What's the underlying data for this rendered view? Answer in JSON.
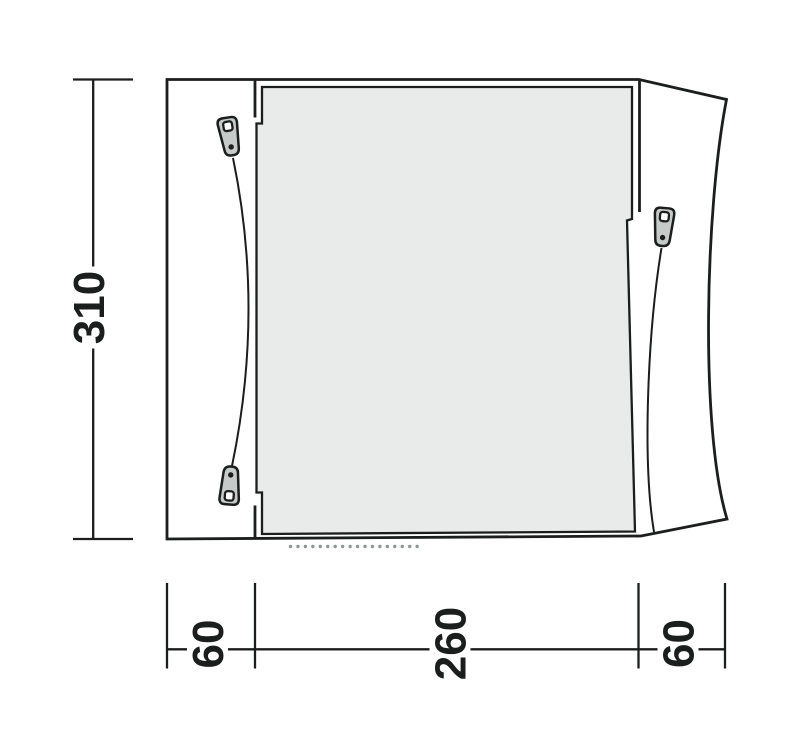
{
  "diagram": {
    "type": "tent-floorplan-top-view",
    "dimension_labels": {
      "left_height": "310",
      "bottom_left": "60",
      "bottom_center": "260",
      "bottom_right": "60"
    },
    "colors": {
      "line": "#1c1e1e",
      "panel_fill": "#e9ebea",
      "zipper_pull_fill": "#c6cac9",
      "entrance_dots": "#8f9595",
      "background": "#ffffff"
    },
    "icons": {
      "zipper_pulls": [
        "zipper-pull-top-left-icon",
        "zipper-pull-bottom-left-icon",
        "zipper-pull-right-icon"
      ],
      "entrance_marking": "dotted-entrance-line"
    }
  }
}
